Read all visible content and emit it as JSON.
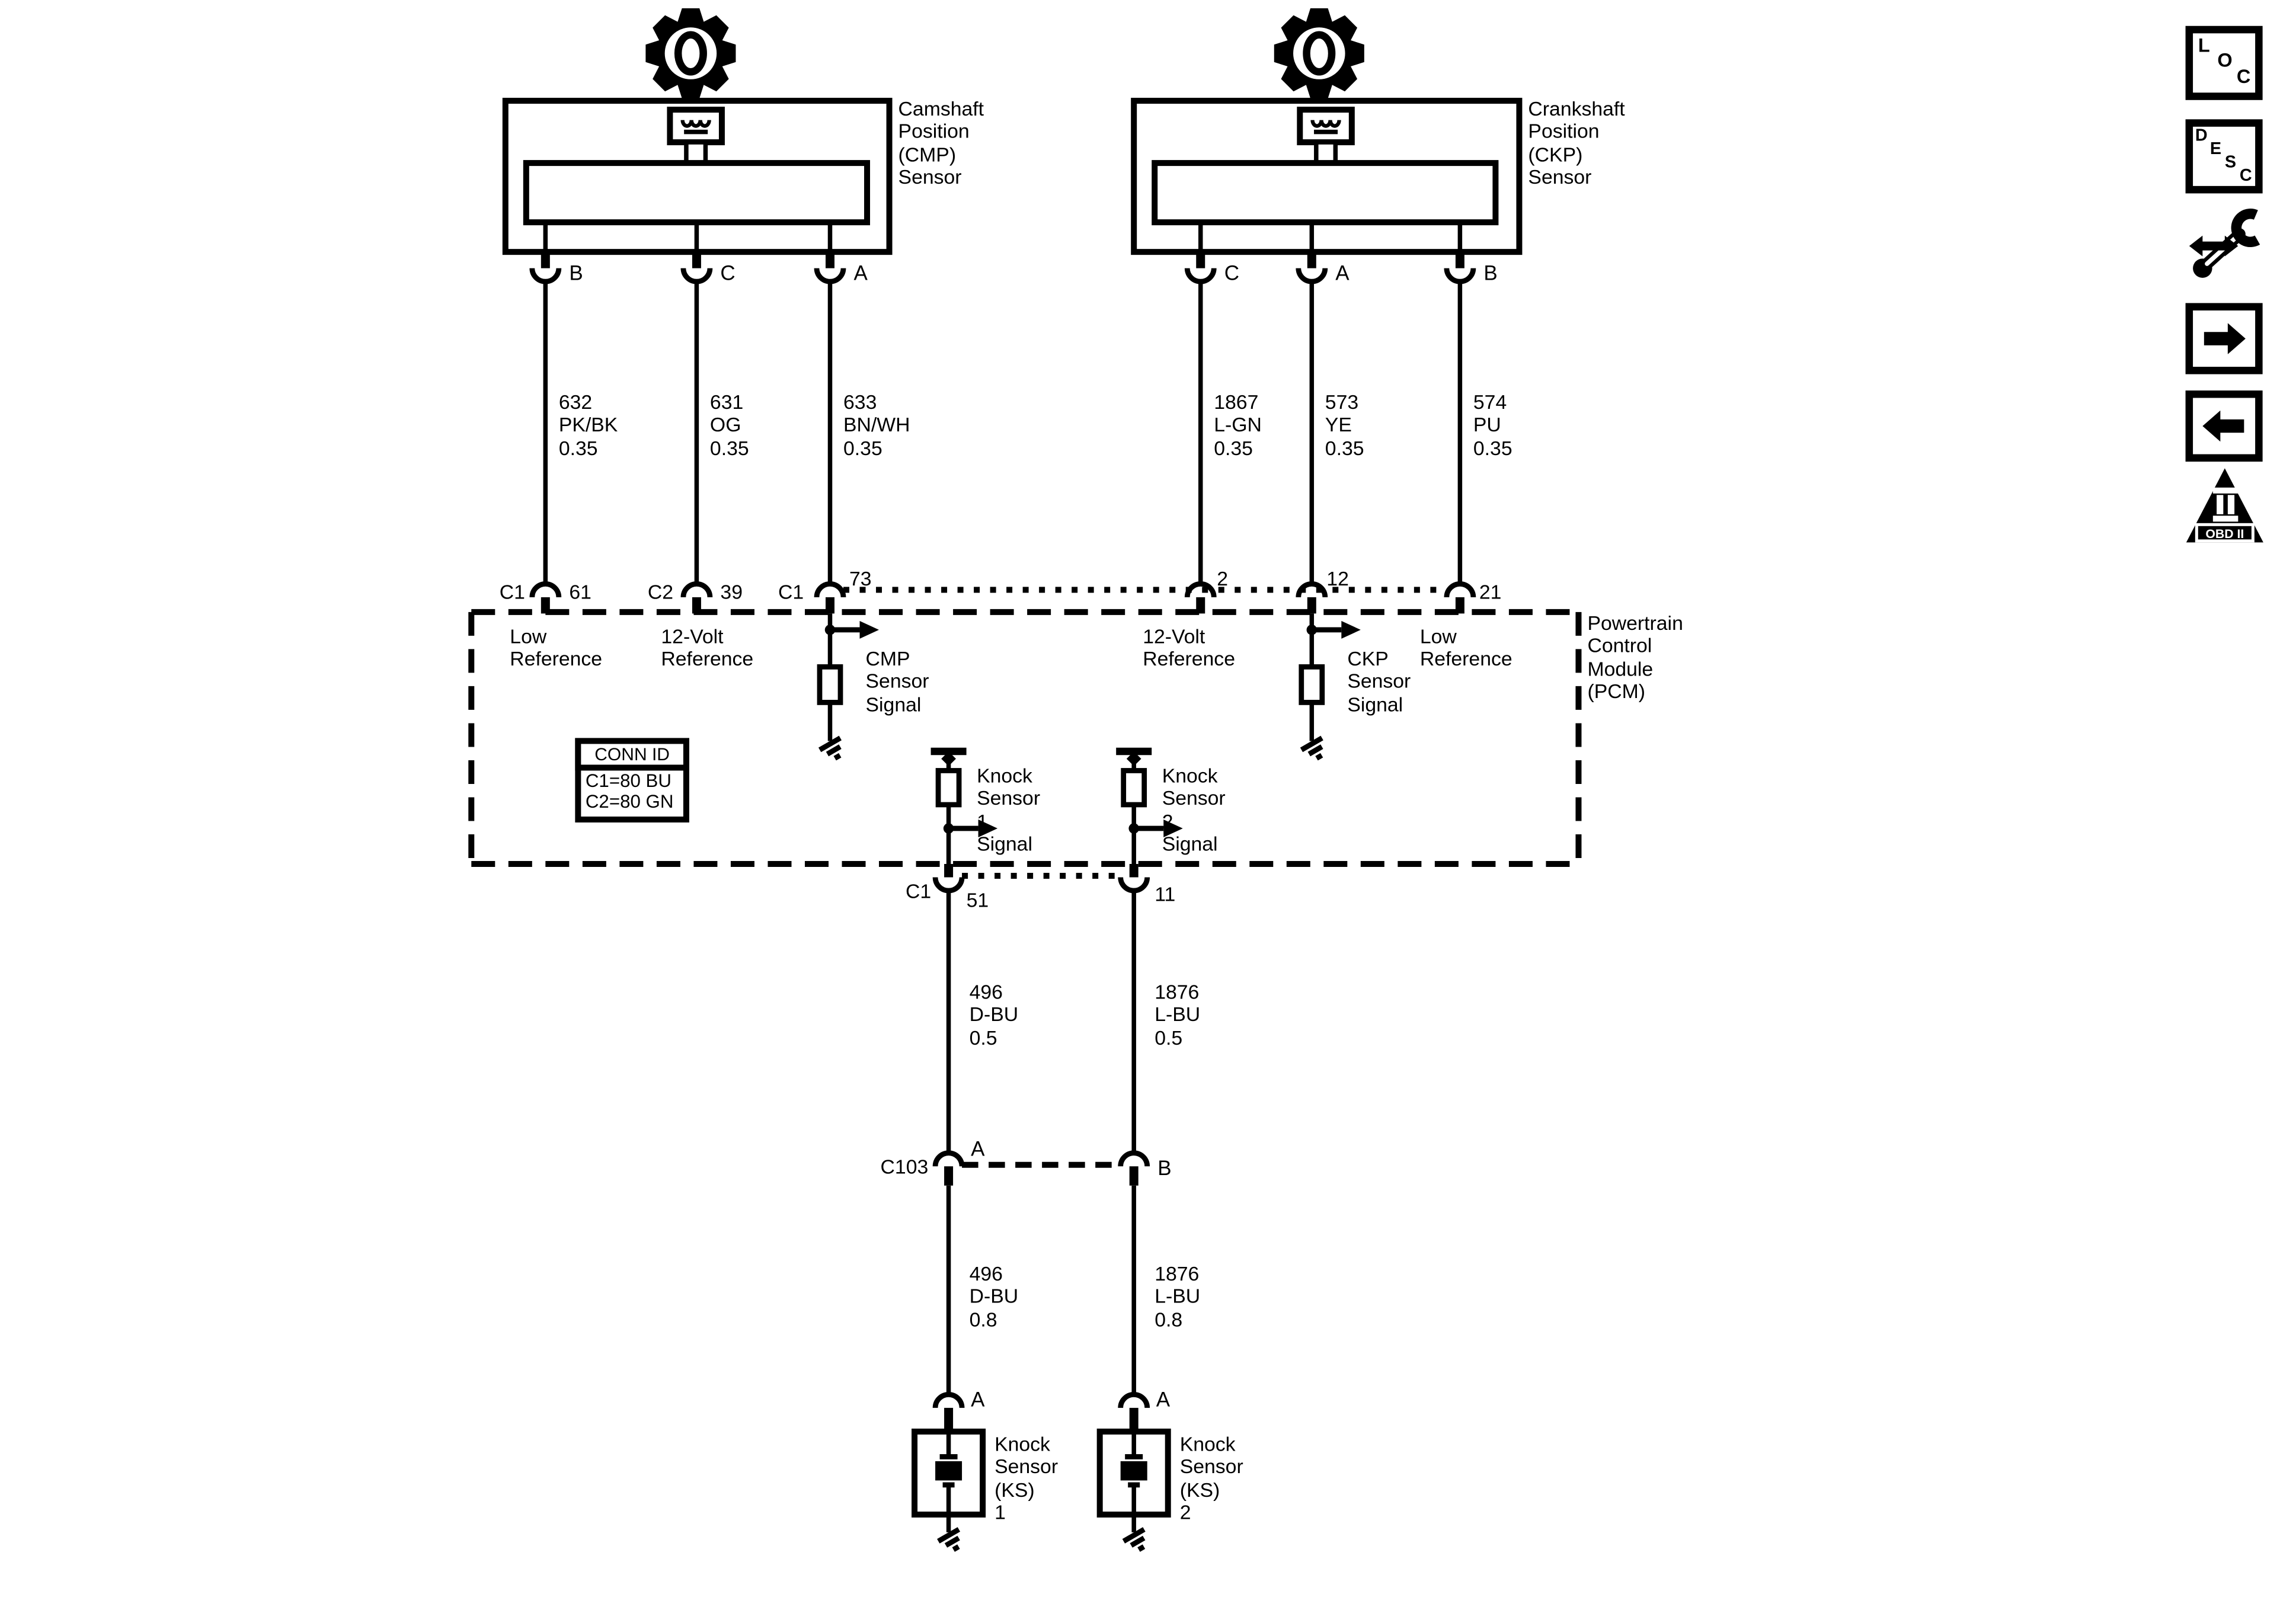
{
  "sensors": {
    "cmp": {
      "title": "Camshaft\nPosition\n(CMP)\nSensor",
      "pin_b": "B",
      "pin_c": "C",
      "pin_a": "A"
    },
    "ckp": {
      "title": "Crankshaft\nPosition\n(CKP)\nSensor",
      "pin_c": "C",
      "pin_a": "A",
      "pin_b": "B"
    }
  },
  "wires": {
    "w632": "632\nPK/BK\n0.35",
    "w631": "631\nOG\n0.35",
    "w633": "633\nBN/WH\n0.35",
    "w1867": "1867\nL-GN\n0.35",
    "w573": "573\nYE\n0.35",
    "w574": "574\nPU\n0.35",
    "w496_05": "496\nD-BU\n0.5",
    "w1876_05": "1876\nL-BU\n0.5",
    "w496_08": "496\nD-BU\n0.8",
    "w1876_08": "1876\nL-BU\n0.8"
  },
  "pcm": {
    "title": "Powertrain\nControl\nModule\n(PCM)",
    "pins": {
      "c1a": "C1",
      "n61": "61",
      "c2": "C2",
      "n39": "39",
      "c1b": "C1",
      "n73": "73",
      "n2": "2",
      "n12": "12",
      "n21": "21",
      "c1c": "C1",
      "n51": "51",
      "n11": "11"
    },
    "functions": {
      "low_ref_l": "Low\nReference",
      "ref12_l": "12-Volt\nReference",
      "cmp_sig": "CMP\nSensor\nSignal",
      "ref12_r": "12-Volt\nReference",
      "ckp_sig": "CKP\nSensor\nSignal",
      "low_ref_r": "Low\nReference",
      "ks1_sig": "Knock\nSensor\n1\nSignal",
      "ks2_sig": "Knock\nSensor\n2\nSignal"
    },
    "conn_id": {
      "title": "CONN ID",
      "c1": "C1=80 BU",
      "c2": "C2=80 GN"
    }
  },
  "c103": {
    "label": "C103",
    "pin_a": "A",
    "pin_b": "B"
  },
  "knock_sensors": {
    "ks1": {
      "pin": "A",
      "label": "Knock\nSensor\n(KS)\n1"
    },
    "ks2": {
      "pin": "A",
      "label": "Knock\nSensor\n(KS)\n2"
    }
  },
  "sidebar": {
    "loc": [
      "L",
      "O",
      "C"
    ],
    "desc": [
      "D",
      "E",
      "S",
      "C"
    ],
    "obd_label": "OBD II"
  },
  "colors": {
    "line": "#000000",
    "background": "#ffffff"
  }
}
